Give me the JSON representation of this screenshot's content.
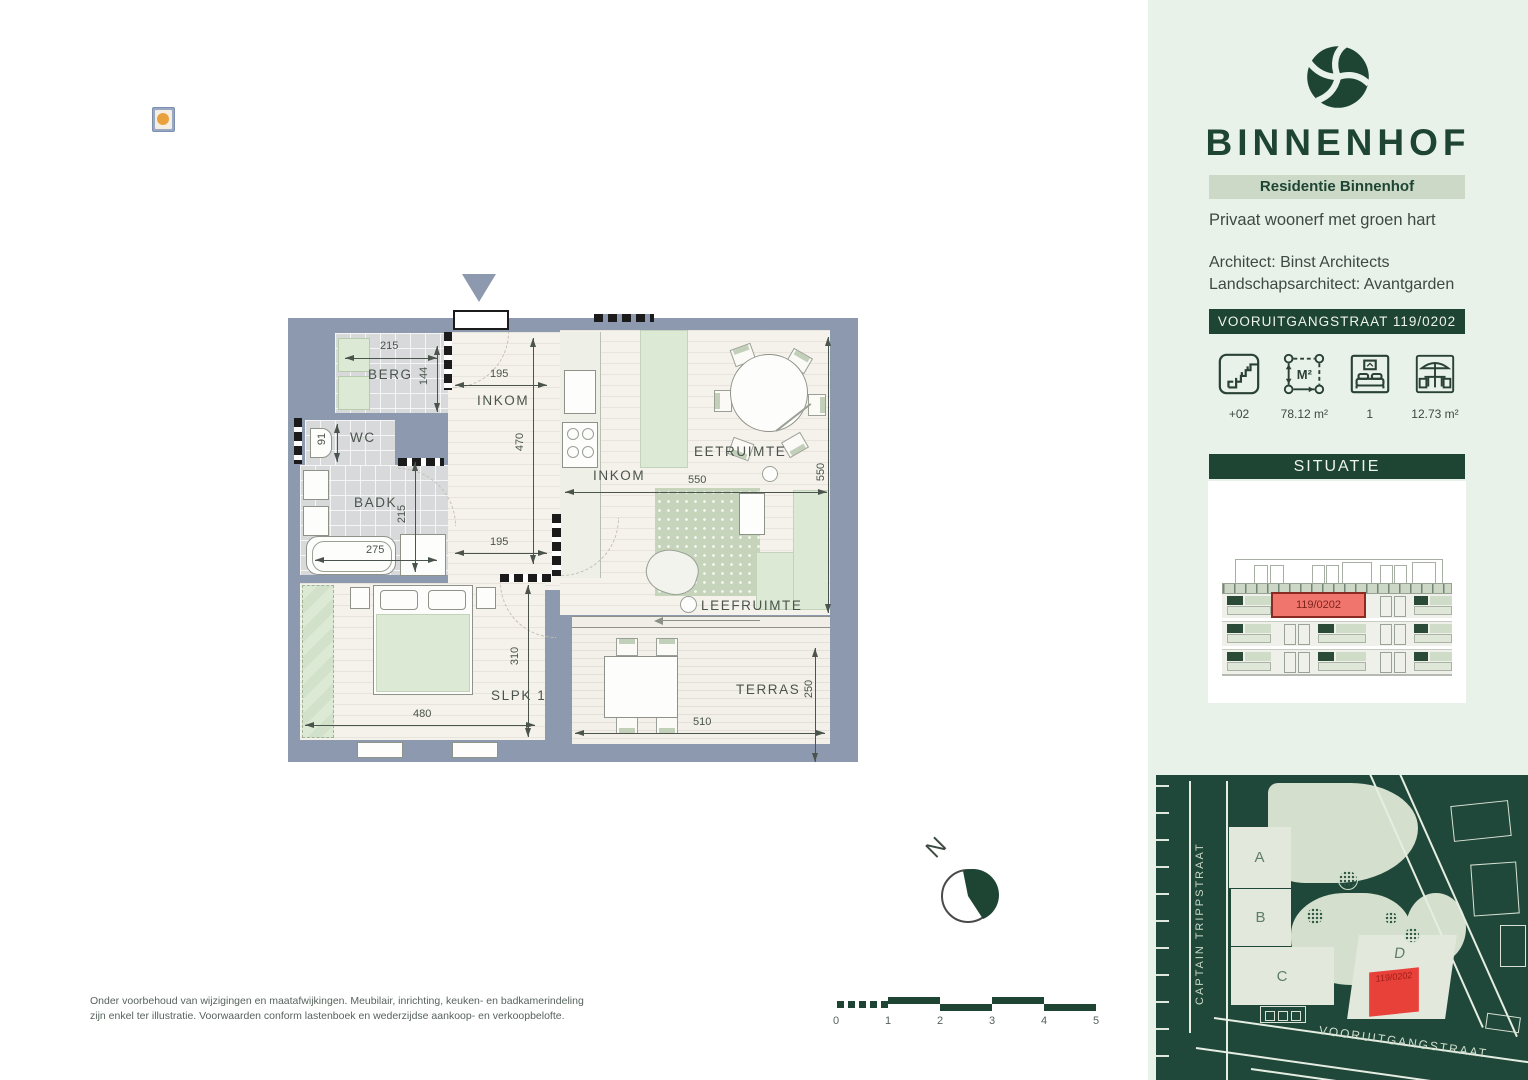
{
  "plan": {
    "rooms": {
      "berg": "BERG",
      "wc": "WC",
      "badk": "BADK",
      "hall": "INKOM",
      "hall2": "INKOM",
      "eat": "EETRUIMTE",
      "live": "LEEFRUIMTE",
      "sleep": "SLPK 1",
      "terrace": "TERRAS"
    },
    "dims": {
      "berg_w": "215",
      "berg_h": "144",
      "hall_top": "195",
      "hall_h": "470",
      "wc": "91",
      "badk": "215",
      "bath": "275",
      "hall_bot": "195",
      "live_w": "550",
      "live_h": "550",
      "sleep_h": "310",
      "sleep_w": "480",
      "terr_w": "510",
      "terr_h": "250"
    }
  },
  "compass": {
    "north": "N"
  },
  "scale_bar": {
    "labels": [
      "0",
      "1",
      "2",
      "3",
      "4",
      "5"
    ]
  },
  "disclaimer": {
    "line1": "Onder voorbehoud van wijzigingen en maatafwijkingen. Meubilair, inrichting, keuken- en badkamerindeling",
    "line2": "zijn enkel ter illustratie. Voorwaarden conform lastenboek en wederzijdse aankoop- en verkoopbelofte."
  },
  "sidebar": {
    "brand": "BINNENHOF",
    "residence": "Residentie Binnenhof",
    "tagline": "Privaat woonerf met groen hart",
    "architect": "Architect: Binst Architects",
    "landscape": "Landschapsarchitect: Avantgarden",
    "address": "VOORUITGANGSTRAAT 119/0202",
    "area_glyph": "M²",
    "stats": [
      {
        "icon": "stairs-icon",
        "value": "+02"
      },
      {
        "icon": "area-icon",
        "value": "78.12 m²"
      },
      {
        "icon": "bedroom-icon",
        "value": "1"
      },
      {
        "icon": "terrace-icon",
        "value": "12.73 m²"
      }
    ]
  },
  "situatie": {
    "title": "SITUATIE",
    "unit": "119/0202"
  },
  "site_map": {
    "buildings": [
      "A",
      "B",
      "C",
      "D"
    ],
    "unit": "119/0202",
    "street_left": "CAPTAIN TRIPPSTRAAT",
    "street_bottom": "VOORUITGANGSTRAAT"
  },
  "colors": {
    "wall": "#8c99ae",
    "dark_green": "#1e4434",
    "sidebar_bg": "#e9f2e9",
    "band": "#ccd9c7",
    "highlight_red": "#ef6964",
    "map_bg": "#20483a"
  }
}
